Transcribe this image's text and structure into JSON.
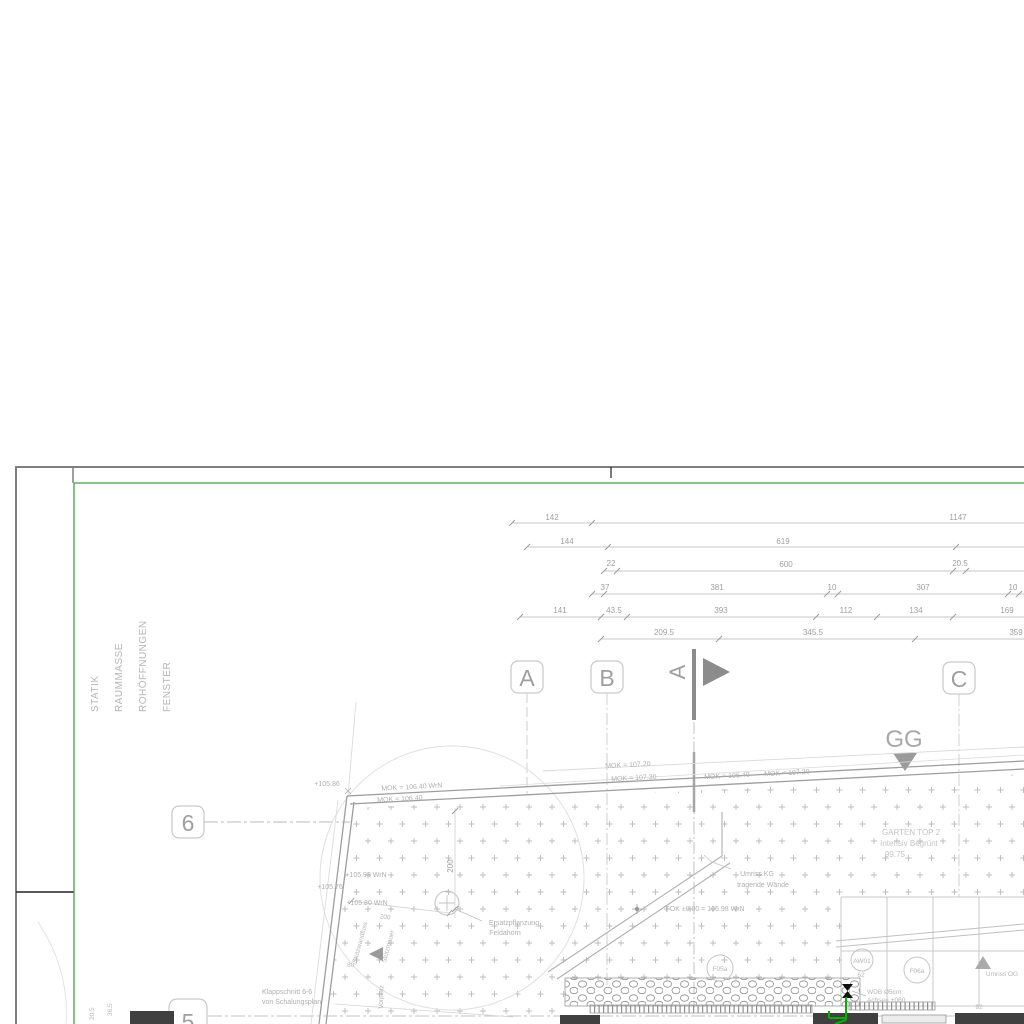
{
  "colors": {
    "sheet_border_green": "#44a044",
    "highlight_green": "#00b300",
    "section_gray": "#8c8c8c",
    "wall_fill_dark": "#404040"
  },
  "margin_labels": {
    "statik": "STATIK",
    "raummasse": "RAUMMASSE",
    "rohoeffnungen": "ROHÖFFNUNGEN",
    "fenster": "FENSTER"
  },
  "grid": {
    "a": "A",
    "b": "B",
    "c": "C",
    "row6": "6",
    "row5": "5",
    "section_letter": "A",
    "gg": "GG"
  },
  "dims": {
    "r1_142": "142",
    "r1_1147": "1147",
    "r2_144": "144",
    "r2_619": "619",
    "r3_22": "22",
    "r3_600": "600",
    "r3_205": "20.5",
    "r4_37": "37",
    "r4_381": "381",
    "r4_10a": "10",
    "r4_307": "307",
    "r4_10b": "10",
    "r5_141": "141",
    "r5_435": "43.5",
    "r5_393": "393",
    "r5_112": "112",
    "r5_134": "134",
    "r5_169": "169",
    "r6_2095": "209.5",
    "r6_3455": "345.5",
    "r6_359": "359",
    "v200": "200",
    "s200": "200",
    "d205": "20.5",
    "d365": "36.5",
    "d62": "62",
    "d92": "92",
    "angle80": "80°"
  },
  "ann": {
    "mok10720a": "MOK = 107.20",
    "mok10730": "MOK = 107.30",
    "mok10640wrn": "MOK = 106.40 WrN",
    "mok10640b": "MOK = 106.40",
    "mok10640c": "MOK = 106.40",
    "mok10720b": "MOK = 107.20",
    "p10586": "+105.86",
    "p10598": "+105.98 WrN",
    "p10576": "+105.76",
    "p10580": "+105.80 WrN",
    "garten1": "GARTEN TOP 2",
    "garten2": "Intensiv Begrünt",
    "garten3": "99.75",
    "umrisskg1": "Umriss KG",
    "umrisskg2": "tragende Wände",
    "fok": "FOK ±0.00 = 105.98 WrN",
    "ersatz1": "Ersatzpflanzung",
    "ersatz2": "Feldahorn",
    "klapp1": "Klappschnitt 6-6",
    "klapp2": "von Schalungsplan",
    "wdb1": "WDB Ø5cm",
    "wdb2": "Achse= +060",
    "umrissog": "Umriss OG",
    "stuetz1": "Stützwandfuss",
    "stuetz2": "Stützmauer",
    "vorplatz": "Vorplatz",
    "f05a": "F05a",
    "f06a": "F06a",
    "aw01": "AW01"
  }
}
